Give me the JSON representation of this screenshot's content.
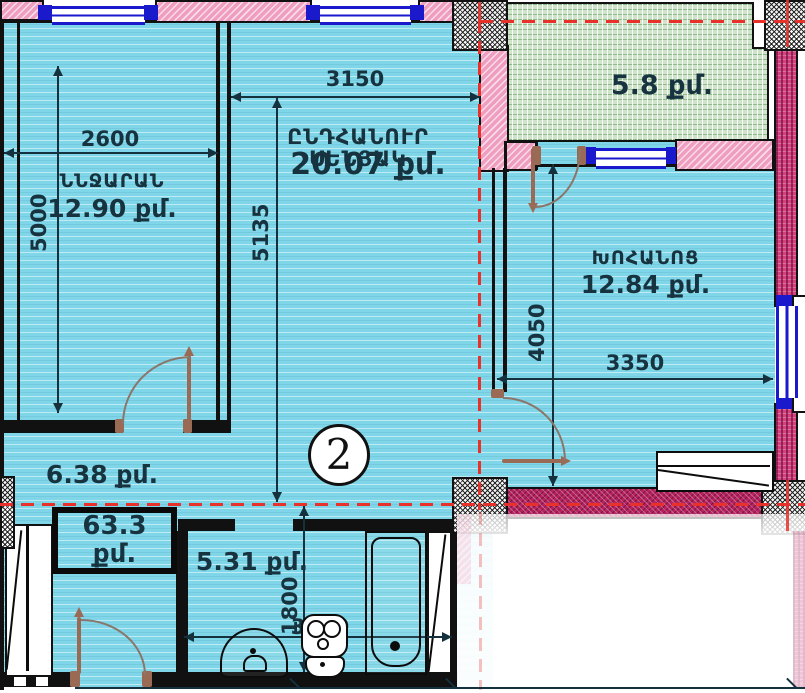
{
  "colors": {
    "floor": "#7fd6e8",
    "wallpink": "#ef9ec0",
    "wallmag": "#b8215f",
    "balconyfill": "#cfe4cb",
    "win": "#1a1acc",
    "door": "#9a6a55",
    "marker": "#e8312a",
    "ink": "#16333f"
  },
  "unit": {
    "number": "2",
    "total_area": "63.3 քմ."
  },
  "rooms": {
    "bedroom": {
      "name": "ՆՆՋԱՐԱՆ",
      "area": "12.90 քմ."
    },
    "living": {
      "name": "ԸՆԴՀԱՆՈՒՐ ՍԵՆՅԱԿ",
      "area": "20.07 քմ."
    },
    "kitchen": {
      "name": "ԽՈՀԱՆՈՑ",
      "area": "12.84 քմ."
    },
    "balcony": {
      "area": "5.8 քմ."
    },
    "hallway": {
      "area": "6.38 քմ."
    },
    "bathroom": {
      "area": "5.31 քմ."
    }
  },
  "dimensions": {
    "bedroom_width": "2600",
    "bedroom_depth": "5000",
    "living_width": "3150",
    "living_depth": "5135",
    "kitchen_depth": "4050",
    "kitchen_width": "3350",
    "bathroom_depth": "1800",
    "bathroom_width": "3000"
  }
}
